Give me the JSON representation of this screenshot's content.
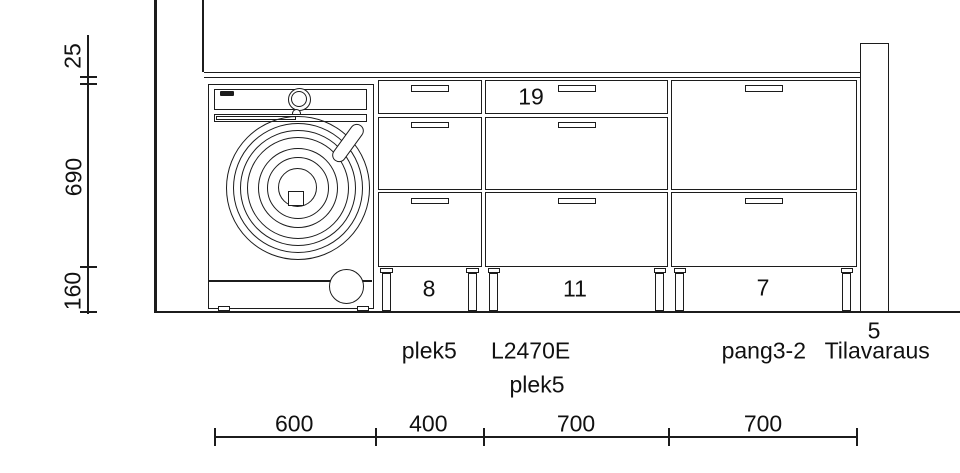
{
  "colors": {
    "line": "#1c1c1c",
    "text": "#111111",
    "background": "#ffffff"
  },
  "left_dimension": {
    "labels": [
      "25",
      "690",
      "160"
    ]
  },
  "bottom_dimension": {
    "labels": [
      "600",
      "400",
      "700",
      "700"
    ]
  },
  "drawer_numbers": {
    "cabinet_a": "8",
    "cabinet_b": "11",
    "cabinet_b_top": "19",
    "cabinet_c": "7"
  },
  "item_labels": {
    "cabinet_a": "plek5",
    "cabinet_b_line1": "L2470E",
    "cabinet_b_line2": "plek5",
    "cabinet_c": "pang3-2",
    "reservation_number": "5",
    "reservation_name": "Tilavaraus"
  }
}
